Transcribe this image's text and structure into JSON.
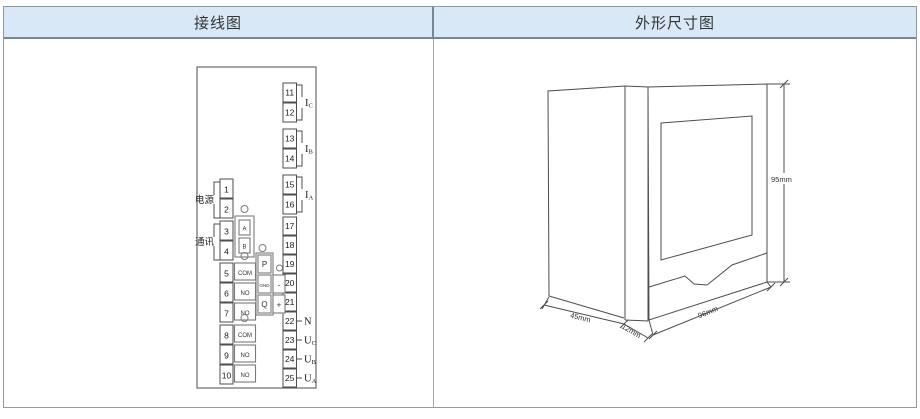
{
  "header": {
    "left_title": "接线图",
    "right_title": "外形尺寸图"
  },
  "wiring": {
    "power_label": "电源",
    "comm_label": "通讯",
    "left_terminals": [
      "1",
      "2",
      "3",
      "4",
      "5",
      "6",
      "7",
      "8",
      "9",
      "10"
    ],
    "right_terminals": [
      "11",
      "12",
      "13",
      "14",
      "15",
      "16",
      "17",
      "18",
      "19",
      "20",
      "21",
      "22",
      "23",
      "24",
      "25"
    ],
    "comm_pins": [
      "A",
      "B"
    ],
    "relay1_pins": [
      "COM",
      "NO",
      "NO"
    ],
    "relay2_pins": [
      "COM",
      "NO",
      "NO"
    ],
    "energy_pins": [
      "P",
      "GND",
      "Q"
    ],
    "polarity_pins": [
      "-",
      "+"
    ],
    "current_labels": [
      {
        "base": "I",
        "sub": "C"
      },
      {
        "base": "I",
        "sub": "B"
      },
      {
        "base": "I",
        "sub": "A"
      }
    ],
    "voltage_labels": [
      {
        "base": "N",
        "sub": ""
      },
      {
        "base": "U",
        "sub": "C"
      },
      {
        "base": "U",
        "sub": "B"
      },
      {
        "base": "U",
        "sub": "A"
      }
    ]
  },
  "dimensions": {
    "height": "95mm",
    "width": "96mm",
    "depth": "45mm",
    "panel_thickness": "12mm"
  },
  "colors": {
    "header_bg": "#d9e8f6",
    "header_border": "#74879a",
    "table_border": "#8d99a6",
    "line": "#4d4d4d"
  }
}
